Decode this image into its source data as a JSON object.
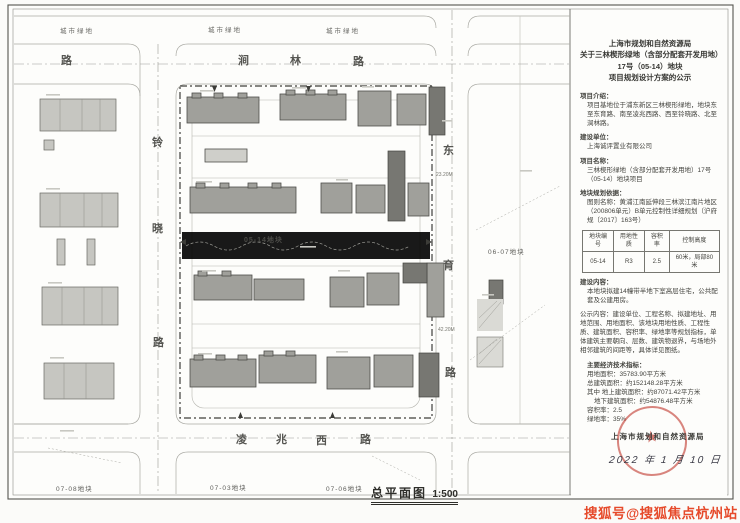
{
  "notice": {
    "title_line1": "上海市规划和自然资源局",
    "title_line2": "关于三林楔形绿地（含部分配套开发用地）",
    "title_line3": "17号（05-14）地块",
    "title_line4": "项目规划设计方案的公示",
    "intro_heading": "项目介绍：",
    "intro_body": "项目基地位于浦东新区三林楔形绿地，地块东至东育路、南至凌兆西路、西至铃晓路、北至涧林路。",
    "developer_heading": "建设单位：",
    "developer_body": "上海诚评置业有限公司",
    "name_heading": "项目名称：",
    "name_body": "三林楔形绿地（含部分配套开发用地）17号（05-14）地块项目",
    "basis_heading": "地块规划依据：",
    "basis_body": "图则名称：黄浦江南延伸段三林滨江南片地区（200806单元）B单元控制性详细规划（沪府规〔2017〕163号）",
    "table": {
      "headers": [
        "地块编号",
        "用地性质",
        "容积率",
        "控制高度"
      ],
      "row": [
        "05-14",
        "R3",
        "2.5",
        "60米，局部80米"
      ]
    },
    "content_heading": "建设内容：",
    "content_body": "本地块拟建14幢带半地下室高层住宅，公共配套及公建用房。",
    "publicity_body": "公示内容：建设单位、工程名称、拟建地址、用地范围、用地面积、该地块用地性质、工程性质、建筑面积、容积率、绿地率等规划指标，单体建筑主要朝向、层数、建筑物退界，与场地外相邻建筑的间距等，具体详见图纸。",
    "indicators_heading": "主要经济技术指标：",
    "ind_land": "用地面积：35783.90平方米",
    "ind_total": "总建筑面积：约152148.28平方米",
    "ind_above": "其中 地上建筑面积：约87071.42平方米",
    "ind_below": "地下建筑面积：约54876.48平方米",
    "ind_far": "容积率：2.5",
    "ind_green": "绿地率：35%",
    "authority": "上海市规划和自然资源局",
    "date": "2022 年 1 月 10 日",
    "seal_star": "★"
  },
  "plan": {
    "green_label": "城市绿地",
    "roads": {
      "north": [
        "涧",
        "林",
        "路"
      ],
      "west": [
        "铃",
        "晓",
        "路"
      ],
      "east": [
        "东",
        "育",
        "路"
      ],
      "south": [
        "凌",
        "兆",
        "西",
        "路"
      ],
      "top_left_char": "路"
    },
    "parcels": {
      "site": "05-14地块",
      "east": "06-07地块",
      "sw": "07-08地块",
      "s1": "07-03地块",
      "s2": "07-06地块"
    },
    "annotations": [
      "23.20M",
      "42.20M"
    ],
    "caption": "总平面图",
    "scale": "1:500"
  },
  "watermark": "搜狐号@搜狐焦点杭州站",
  "colors": {
    "seal_red": "#c4453a",
    "watermark_red": "#e64a2b",
    "building_gray": "#a0a09b",
    "dark_block": "#777772"
  }
}
